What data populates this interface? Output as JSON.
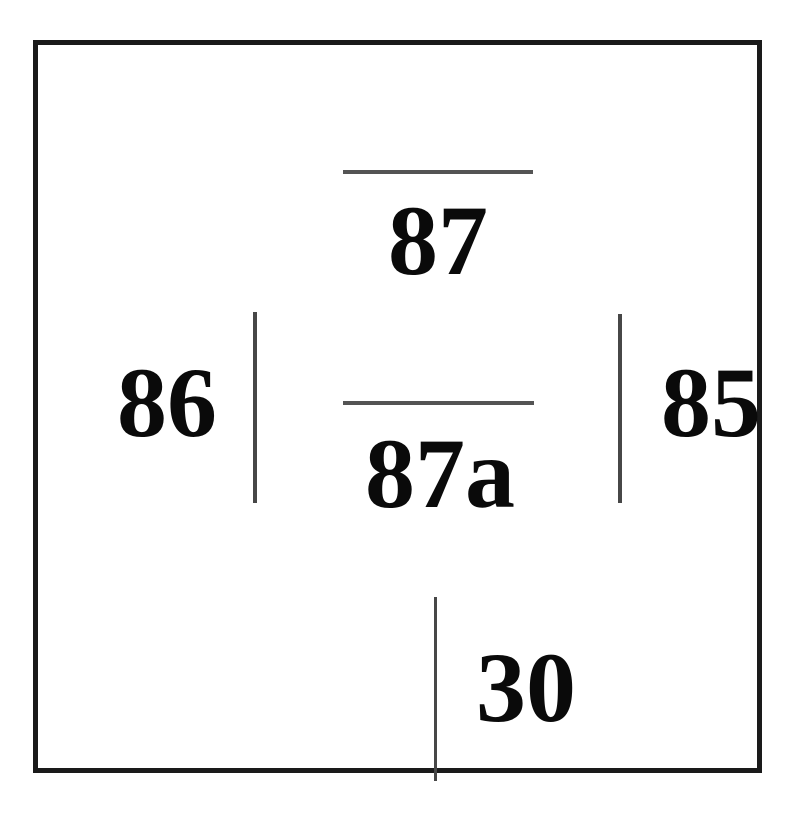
{
  "diagram": {
    "colors": {
      "background": "#ffffff",
      "outline": "#1a1a1a",
      "terminal_line": "#4f4f4f",
      "label_text": "#0a0a0a"
    },
    "pins": {
      "p87": {
        "label": "87"
      },
      "p87a": {
        "label": "87a"
      },
      "p86": {
        "label": "86"
      },
      "p85": {
        "label": "85"
      },
      "p30": {
        "label": "30"
      }
    }
  }
}
